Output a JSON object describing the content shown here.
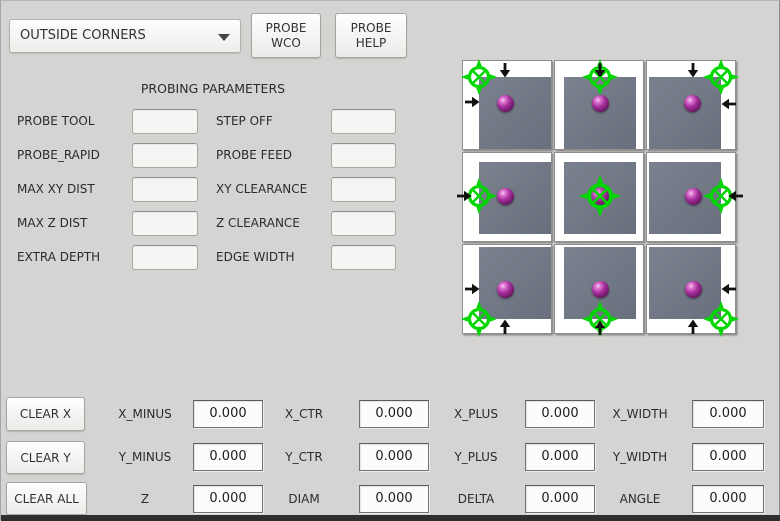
{
  "header": {
    "mode_dropdown": {
      "value": "OUTSIDE CORNERS"
    },
    "probe_wco_lines": [
      "PROBE",
      "WCO"
    ],
    "probe_help_lines": [
      "PROBE",
      "HELP"
    ]
  },
  "parameters": {
    "title": "PROBING PARAMETERS",
    "rows": [
      {
        "left": {
          "label": "PROBE TOOL",
          "value": ""
        },
        "right": {
          "label": "STEP OFF",
          "value": ""
        }
      },
      {
        "left": {
          "label": "PROBE_RAPID",
          "value": ""
        },
        "right": {
          "label": "PROBE FEED",
          "value": ""
        }
      },
      {
        "left": {
          "label": "MAX XY DIST",
          "value": ""
        },
        "right": {
          "label": "XY CLEARANCE",
          "value": ""
        }
      },
      {
        "left": {
          "label": "MAX Z DIST",
          "value": ""
        },
        "right": {
          "label": "Z CLEARANCE",
          "value": ""
        }
      },
      {
        "left": {
          "label": "EXTRA DEPTH",
          "value": ""
        },
        "right": {
          "label": "EDGE WIDTH",
          "value": ""
        }
      }
    ]
  },
  "diagram": {
    "description": "3x3 grid of outside-corner / edge / center probing position illustrations",
    "cells": [
      {
        "id": "top-left",
        "row": 0,
        "col": 0,
        "square": {
          "top": 16,
          "left": 16
        },
        "cross": {
          "x": 16,
          "y": 16,
          "size": 38
        },
        "ball": {
          "x": 42,
          "y": 42
        },
        "arrows": [
          {
            "dir": "down",
            "left": 34,
            "top": 1
          },
          {
            "dir": "right",
            "left": 1,
            "top": 33
          }
        ]
      },
      {
        "id": "top-center",
        "row": 0,
        "col": 1,
        "square": {
          "top": 16,
          "left": 9
        },
        "cross": {
          "x": 45,
          "y": 16,
          "size": 38
        },
        "ball": {
          "x": 45,
          "y": 42
        },
        "arrows": [
          {
            "dir": "down",
            "left": 37,
            "top": 1
          }
        ]
      },
      {
        "id": "top-right",
        "row": 0,
        "col": 2,
        "square": {
          "top": 16,
          "left": 2
        },
        "cross": {
          "x": 74,
          "y": 16,
          "size": 38
        },
        "ball": {
          "x": 45,
          "y": 42
        },
        "arrows": [
          {
            "dir": "down",
            "left": 38,
            "top": 1
          },
          {
            "dir": "left",
            "left": 74,
            "top": 35
          }
        ]
      },
      {
        "id": "middle-left",
        "row": 1,
        "col": 0,
        "square": {
          "top": 9,
          "left": 16
        },
        "cross": {
          "x": 16,
          "y": 43,
          "size": 38
        },
        "ball": {
          "x": 42,
          "y": 43
        },
        "arrows": [
          {
            "dir": "right",
            "left": -7,
            "top": 35
          }
        ]
      },
      {
        "id": "center",
        "row": 1,
        "col": 1,
        "square": {
          "top": 9,
          "left": 9
        },
        "cross": {
          "x": 45,
          "y": 43,
          "size": 44
        },
        "ball": {
          "x": 45,
          "y": 43
        },
        "arrows": []
      },
      {
        "id": "middle-right",
        "row": 1,
        "col": 2,
        "square": {
          "top": 9,
          "left": 2
        },
        "cross": {
          "x": 74,
          "y": 43,
          "size": 38
        },
        "ball": {
          "x": 46,
          "y": 43
        },
        "arrows": [
          {
            "dir": "left",
            "left": 81,
            "top": 35
          }
        ]
      },
      {
        "id": "bottom-left",
        "row": 2,
        "col": 0,
        "square": {
          "top": 2,
          "left": 16
        },
        "cross": {
          "x": 16,
          "y": 74,
          "size": 38
        },
        "ball": {
          "x": 42,
          "y": 44
        },
        "arrows": [
          {
            "dir": "right",
            "left": 1,
            "top": 36
          },
          {
            "dir": "up",
            "left": 34,
            "top": 74
          }
        ]
      },
      {
        "id": "bottom-center",
        "row": 2,
        "col": 1,
        "square": {
          "top": 2,
          "left": 9
        },
        "cross": {
          "x": 45,
          "y": 74,
          "size": 38
        },
        "ball": {
          "x": 45,
          "y": 44
        },
        "arrows": [
          {
            "dir": "up",
            "left": 37,
            "top": 75
          }
        ]
      },
      {
        "id": "bottom-right",
        "row": 2,
        "col": 2,
        "square": {
          "top": 2,
          "left": 2
        },
        "cross": {
          "x": 74,
          "y": 74,
          "size": 38
        },
        "ball": {
          "x": 46,
          "y": 44
        },
        "arrows": [
          {
            "dir": "left",
            "left": 74,
            "top": 36
          },
          {
            "dir": "up",
            "left": 38,
            "top": 74
          }
        ]
      }
    ]
  },
  "results": {
    "clear_buttons": [
      {
        "label": "CLEAR X"
      },
      {
        "label": "CLEAR Y"
      },
      {
        "label": "CLEAR ALL"
      }
    ],
    "rows": [
      {
        "cells": [
          {
            "label": "X_MINUS",
            "value": "0.000"
          },
          {
            "label": "X_CTR",
            "value": "0.000"
          },
          {
            "label": "X_PLUS",
            "value": "0.000"
          },
          {
            "label": "X_WIDTH",
            "value": "0.000"
          }
        ]
      },
      {
        "cells": [
          {
            "label": "Y_MINUS",
            "value": "0.000"
          },
          {
            "label": "Y_CTR",
            "value": "0.000"
          },
          {
            "label": "Y_PLUS",
            "value": "0.000"
          },
          {
            "label": "Y_WIDTH",
            "value": "0.000"
          }
        ]
      },
      {
        "cells": [
          {
            "label": "Z",
            "value": "0.000"
          },
          {
            "label": "DIAM",
            "value": "0.000"
          },
          {
            "label": "DELTA",
            "value": "0.000"
          },
          {
            "label": "ANGLE",
            "value": "0.000"
          }
        ]
      }
    ]
  },
  "colors": {
    "background": "#d5d4d2",
    "crosshair_green": "#00d600",
    "ball_purple": "#a42f9c",
    "workpiece_gray": "#717886",
    "arrow_black": "#111111",
    "bottom_border": "#2e2e2e"
  }
}
